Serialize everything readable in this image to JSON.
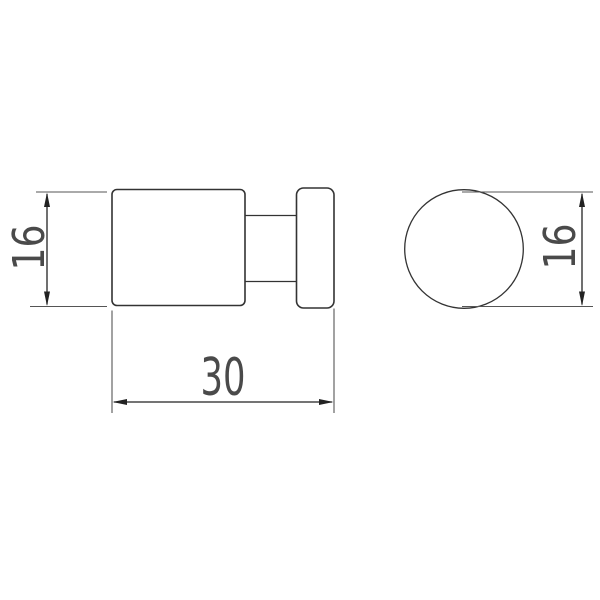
{
  "drawing": {
    "kind": "two-view dimensioned technical drawing",
    "dimensions": {
      "side_height": "16",
      "side_length": "30",
      "front_diameter": "16"
    },
    "colors": {
      "background": "#ffffff",
      "outline": "#333333",
      "dimension": "#222222",
      "extension": "#555555",
      "text": "#4a4a4a"
    }
  }
}
